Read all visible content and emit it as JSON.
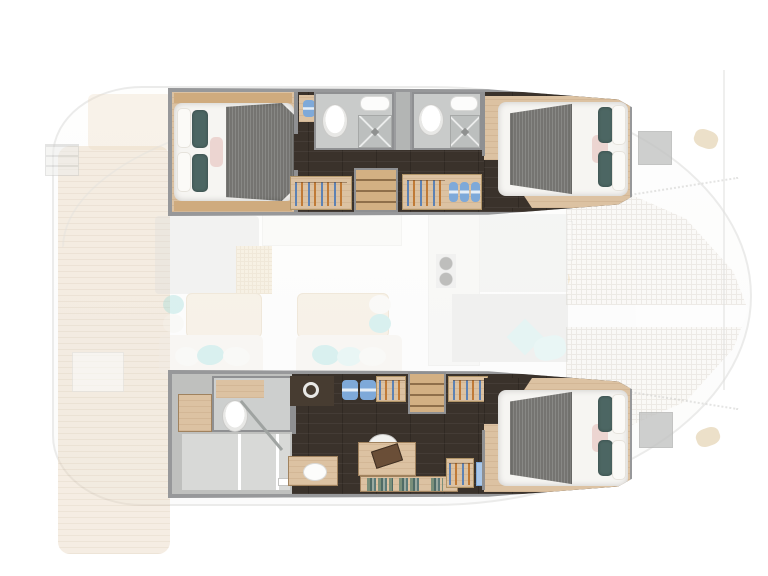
{
  "diagram": {
    "type": "yacht-floor-plan",
    "subject": "Catamaran interior layout, top-down view, bow to the right, lower-deck hulls shown in focus over a faded deck plan",
    "double_beds": 3,
    "toilets": 3,
    "showers": 3,
    "washbasins": 3,
    "wardrobes": 5,
    "companionway_stairs": 2
  },
  "colors": {
    "wall_gray": "#97989a",
    "dark_wood_floor": "#3a322b",
    "light_wood": "#dcc2a2",
    "wood_trim": "#cfab7e",
    "bathroom_floor": "#c9cbca",
    "shower_tray": "#bcbfbe",
    "duvet_white": "#f6f5f2",
    "blanket_gray": "#757471",
    "pillow_teal_dark": "#4c6663",
    "pillow_teal_light": "#9adbd8",
    "pillow_pink": "#ecd5d1",
    "towel_blue": "#7ea9d9",
    "hanger_blue": "#5d82b4",
    "hanger_orange": "#c07a36",
    "saloon_table_wood": "#eedec5",
    "deck_plank": "#e6d2b6",
    "hatch_gray": "#c3c4c3",
    "washer_body": "#473c31"
  },
  "port_hull": {
    "aft_cabin": {
      "bed": "double",
      "blanket": "gray",
      "pillows": [
        "white",
        "white",
        "dark-teal",
        "dark-teal",
        "pink"
      ]
    },
    "bathroom_aft": {
      "fixtures": [
        "toilet",
        "washbasin",
        "shower"
      ]
    },
    "bathroom_forward": {
      "fixtures": [
        "toilet",
        "washbasin",
        "shower"
      ]
    },
    "wardrobe_aft": "hangers",
    "wardrobe_forward": "hangers and blue towels",
    "stairs": "companionway from saloon",
    "forward_cabin": {
      "bed": "double",
      "blanket": "gray",
      "pillows": [
        "white",
        "white",
        "dark-teal",
        "dark-teal",
        "pink"
      ]
    }
  },
  "starboard_hull": {
    "aft_bathroom": {
      "fixtures": [
        "toilet",
        "separate shower room",
        "washbasin",
        "cabinet"
      ]
    },
    "utility": {
      "appliance": "washing-machine",
      "towels": "blue"
    },
    "study": {
      "furniture": [
        "desk",
        "chair",
        "laptop",
        "bookshelf with books"
      ]
    },
    "wardrobes": [
      "hangers",
      "hangers",
      "hangers"
    ],
    "stairs": "companionway from saloon",
    "forward_cabin": {
      "bed": "double",
      "blanket": "gray",
      "pillows": [
        "white",
        "white",
        "dark-teal",
        "dark-teal",
        "pink"
      ]
    }
  },
  "saloon_faded": {
    "tables": 2,
    "sofa_pillows": [
      "teal",
      "white",
      "light-teal"
    ],
    "galley": [
      "counter",
      "stove-burners",
      "vent-grate"
    ],
    "foredeck": [
      "lounge-cushions",
      "teal-pillows",
      "deck-hatch"
    ]
  },
  "exterior_faded": {
    "trampoline": "bow netting grid",
    "deck_hatches": 2,
    "winch_pads": 2,
    "swim_steps": "stern ladder, port side"
  }
}
